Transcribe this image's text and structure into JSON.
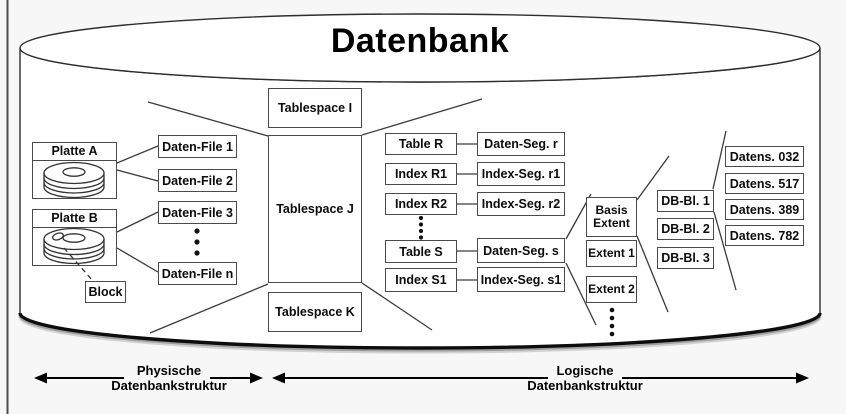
{
  "diagram": {
    "title": "Datenbank",
    "disks": [
      {
        "label": "Platte A"
      },
      {
        "label": "Platte B"
      }
    ],
    "block_label": "Block",
    "data_files": [
      "Daten-File 1",
      "Daten-File 2",
      "Daten-File 3",
      "Daten-File n"
    ],
    "tablespaces": [
      "Tablespace I",
      "Tablespace J",
      "Tablespace K"
    ],
    "segment_rows": [
      {
        "object": "Table R",
        "segment": "Daten-Seg. r"
      },
      {
        "object": "Index R1",
        "segment": "Index-Seg. r1"
      },
      {
        "object": "Index R2",
        "segment": "Index-Seg. r2"
      },
      {
        "object": "Table S",
        "segment": "Daten-Seg. s"
      },
      {
        "object": "Index S1",
        "segment": "Index-Seg. s1"
      }
    ],
    "extents": [
      "Basis Extent",
      "Extent 1",
      "Extent 2"
    ],
    "db_blocks": [
      "DB-Bl. 1",
      "DB-Bl. 2",
      "DB-Bl. 3"
    ],
    "records": [
      "Datens. 032",
      "Datens. 517",
      "Datens. 389",
      "Datens. 782"
    ],
    "axes": {
      "physical": {
        "title": "Physische",
        "subtitle": "Datenbankstruktur"
      },
      "logical": {
        "title": "Logische",
        "subtitle": "Datenbankstruktur"
      }
    },
    "icons": {
      "disk": "disk-stack-icon",
      "block_marker": "block-marker-icon"
    },
    "colors": {
      "line": "#3a3a3a",
      "box_border": "#4a4a4a",
      "background": "#f7f7f7",
      "cylinder_fill": "#ffffff",
      "shadow": "#8f8f8f",
      "text": "#0c0c0c"
    }
  }
}
